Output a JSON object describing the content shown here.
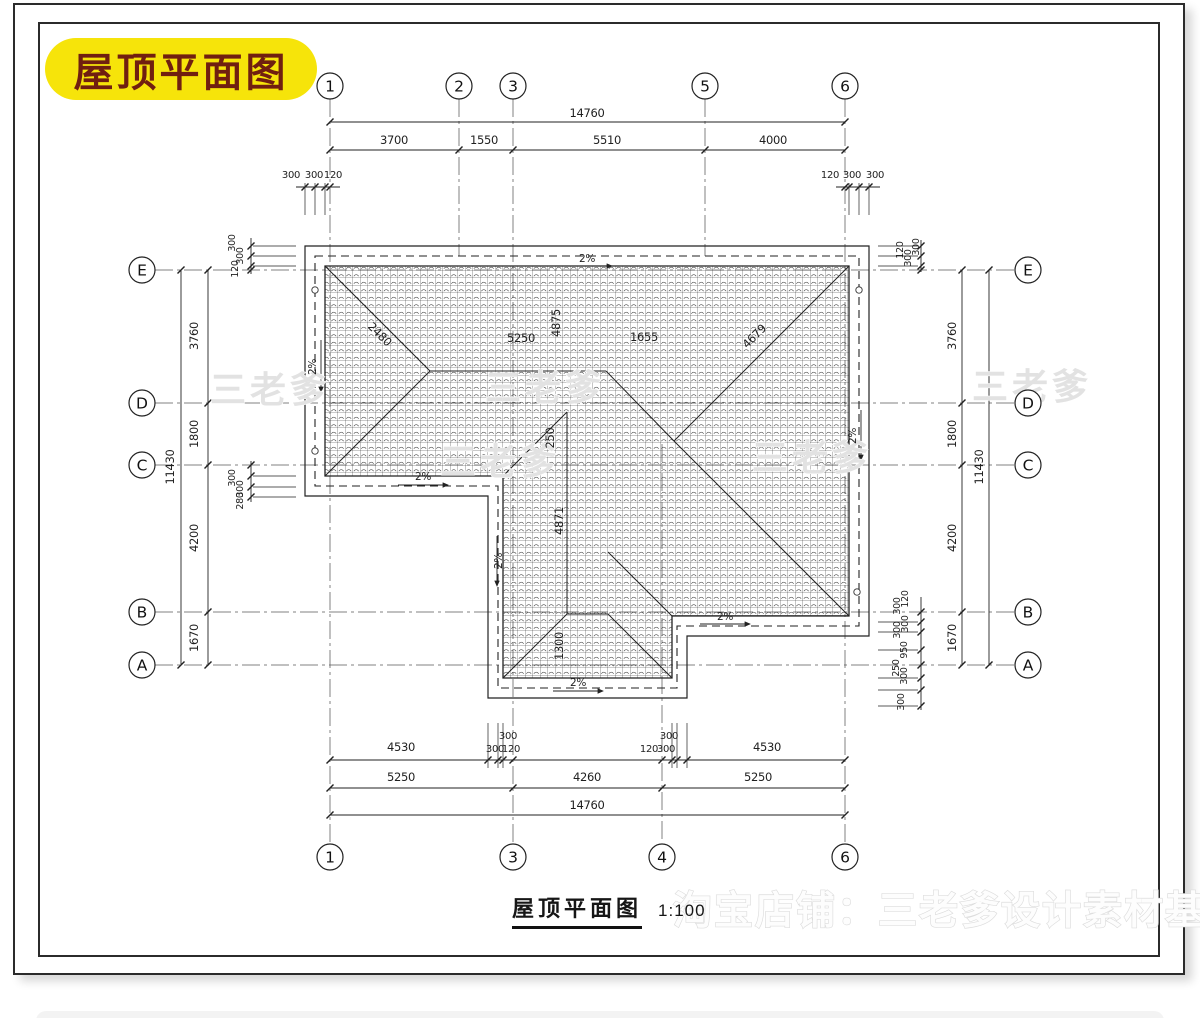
{
  "header": {
    "label": "屋顶平面图"
  },
  "caption": {
    "title": "屋顶平面图",
    "scale": "1:100"
  },
  "colors": {
    "highlight_bg": "#f6e40a",
    "highlight_text": "#701f10",
    "ink": "#1f1f1f",
    "axis_line": "#5a5a5a",
    "watermark": "#e2e2e2"
  },
  "axis_bubbles": {
    "top": [
      {
        "label": "1",
        "x": 330,
        "y": 86
      },
      {
        "label": "2",
        "x": 459,
        "y": 86
      },
      {
        "label": "3",
        "x": 513,
        "y": 86
      },
      {
        "label": "5",
        "x": 705,
        "y": 86
      },
      {
        "label": "6",
        "x": 845,
        "y": 86
      }
    ],
    "bottom": [
      {
        "label": "1",
        "x": 330,
        "y": 857
      },
      {
        "label": "3",
        "x": 513,
        "y": 857
      },
      {
        "label": "4",
        "x": 662,
        "y": 857
      },
      {
        "label": "6",
        "x": 845,
        "y": 857
      }
    ],
    "left": [
      {
        "label": "E",
        "x": 142,
        "y": 270
      },
      {
        "label": "D",
        "x": 142,
        "y": 403
      },
      {
        "label": "C",
        "x": 142,
        "y": 465
      },
      {
        "label": "B",
        "x": 142,
        "y": 612
      },
      {
        "label": "A",
        "x": 142,
        "y": 665
      }
    ],
    "right": [
      {
        "label": "E",
        "x": 1028,
        "y": 270
      },
      {
        "label": "D",
        "x": 1028,
        "y": 403
      },
      {
        "label": "C",
        "x": 1028,
        "y": 465
      },
      {
        "label": "B",
        "x": 1028,
        "y": 612
      },
      {
        "label": "A",
        "x": 1028,
        "y": 665
      }
    ]
  },
  "dimension_labels": [
    {
      "t": "14760",
      "x": 587,
      "y": 117
    },
    {
      "t": "3700",
      "x": 394,
      "y": 144
    },
    {
      "t": "1550",
      "x": 484,
      "y": 144
    },
    {
      "t": "5510",
      "x": 607,
      "y": 144
    },
    {
      "t": "4000",
      "x": 773,
      "y": 144
    },
    {
      "t": "300",
      "x": 291,
      "y": 178,
      "s": 10
    },
    {
      "t": "300",
      "x": 314,
      "y": 178,
      "s": 10
    },
    {
      "t": "120",
      "x": 333,
      "y": 178,
      "s": 10
    },
    {
      "t": "120",
      "x": 830,
      "y": 178,
      "s": 10
    },
    {
      "t": "300",
      "x": 852,
      "y": 178,
      "s": 10
    },
    {
      "t": "300",
      "x": 875,
      "y": 178,
      "s": 10
    },
    {
      "t": "4530",
      "x": 401,
      "y": 751
    },
    {
      "t": "300",
      "x": 508,
      "y": 739,
      "s": 10
    },
    {
      "t": "300",
      "x": 495,
      "y": 752,
      "s": 10
    },
    {
      "t": "120",
      "x": 511,
      "y": 752,
      "s": 10
    },
    {
      "t": "120",
      "x": 649,
      "y": 752,
      "s": 10
    },
    {
      "t": "300",
      "x": 666,
      "y": 752,
      "s": 10
    },
    {
      "t": "300",
      "x": 669,
      "y": 739,
      "s": 10
    },
    {
      "t": "4530",
      "x": 767,
      "y": 751
    },
    {
      "t": "5250",
      "x": 401,
      "y": 781
    },
    {
      "t": "4260",
      "x": 587,
      "y": 781
    },
    {
      "t": "5250",
      "x": 758,
      "y": 781
    },
    {
      "t": "14760",
      "x": 587,
      "y": 809
    },
    {
      "t": "11430",
      "x": 174,
      "y": 467,
      "r": -90
    },
    {
      "t": "3760",
      "x": 198,
      "y": 336,
      "r": -90
    },
    {
      "t": "1800",
      "x": 198,
      "y": 434,
      "r": -90
    },
    {
      "t": "4200",
      "x": 198,
      "y": 538,
      "r": -90
    },
    {
      "t": "1670",
      "x": 198,
      "y": 638,
      "r": -90
    },
    {
      "t": "300",
      "x": 235,
      "y": 243,
      "r": -90,
      "s": 9.5
    },
    {
      "t": "300",
      "x": 243,
      "y": 256,
      "r": -90,
      "s": 9.5
    },
    {
      "t": "120",
      "x": 238,
      "y": 269,
      "r": -90,
      "s": 9.5
    },
    {
      "t": "300",
      "x": 235,
      "y": 478,
      "r": -90,
      "s": 9.5
    },
    {
      "t": "300",
      "x": 243,
      "y": 489,
      "r": -90,
      "s": 9.5
    },
    {
      "t": "280",
      "x": 243,
      "y": 501,
      "r": -90,
      "s": 9.5
    },
    {
      "t": "11430",
      "x": 983,
      "y": 467,
      "r": -90
    },
    {
      "t": "3760",
      "x": 956,
      "y": 336,
      "r": -90
    },
    {
      "t": "1800",
      "x": 956,
      "y": 434,
      "r": -90
    },
    {
      "t": "4200",
      "x": 956,
      "y": 538,
      "r": -90
    },
    {
      "t": "1670",
      "x": 956,
      "y": 638,
      "r": -90
    },
    {
      "t": "120",
      "x": 903,
      "y": 250,
      "r": -90,
      "s": 9.5
    },
    {
      "t": "300",
      "x": 911,
      "y": 258,
      "r": -90,
      "s": 9.5
    },
    {
      "t": "300",
      "x": 919,
      "y": 247,
      "r": -90,
      "s": 9.5
    },
    {
      "t": "120",
      "x": 908,
      "y": 599,
      "r": -90,
      "s": 9.5
    },
    {
      "t": "300",
      "x": 900,
      "y": 606,
      "r": -90,
      "s": 9.5
    },
    {
      "t": "300",
      "x": 908,
      "y": 624,
      "r": -90,
      "s": 9.5
    },
    {
      "t": "300",
      "x": 900,
      "y": 630,
      "r": -90,
      "s": 9.5
    },
    {
      "t": "950",
      "x": 907,
      "y": 650,
      "r": -90,
      "s": 9.5
    },
    {
      "t": "250",
      "x": 899,
      "y": 668,
      "r": -90,
      "s": 9.5
    },
    {
      "t": "300",
      "x": 907,
      "y": 676,
      "r": -90,
      "s": 9.5
    },
    {
      "t": "300",
      "x": 904,
      "y": 702,
      "r": -90,
      "s": 9.5
    }
  ],
  "roof_labels": [
    {
      "t": "2480",
      "x": 377,
      "y": 337,
      "r": 45
    },
    {
      "t": "5250",
      "x": 521,
      "y": 342
    },
    {
      "t": "4875",
      "x": 560,
      "y": 323,
      "r": -90
    },
    {
      "t": "1655",
      "x": 644,
      "y": 341
    },
    {
      "t": "4679",
      "x": 757,
      "y": 339,
      "r": -45
    },
    {
      "t": "250",
      "x": 554,
      "y": 438,
      "r": -90
    },
    {
      "t": "4871",
      "x": 563,
      "y": 521,
      "r": -90
    },
    {
      "t": "1300",
      "x": 563,
      "y": 646,
      "r": -90
    }
  ],
  "slope_labels": [
    {
      "t": "2%",
      "x": 587,
      "y": 262
    },
    {
      "t": "2%",
      "x": 423,
      "y": 480
    },
    {
      "t": "2%",
      "x": 578,
      "y": 686
    },
    {
      "t": "2%",
      "x": 856,
      "y": 436,
      "r": -90
    },
    {
      "t": "2%",
      "x": 725,
      "y": 620
    },
    {
      "t": "2%",
      "x": 502,
      "y": 561,
      "r": -90
    },
    {
      "t": "2%",
      "x": 316,
      "y": 367,
      "r": -90
    }
  ],
  "watermarks": {
    "tile_text": "三老爹",
    "tiles": [
      {
        "x": 270,
        "y": 402
      },
      {
        "x": 545,
        "y": 400
      },
      {
        "x": 1032,
        "y": 399
      },
      {
        "x": 500,
        "y": 474
      },
      {
        "x": 812,
        "y": 470
      }
    ],
    "bottom_text": "淘宝店铺：三老爹设计素材基地"
  }
}
